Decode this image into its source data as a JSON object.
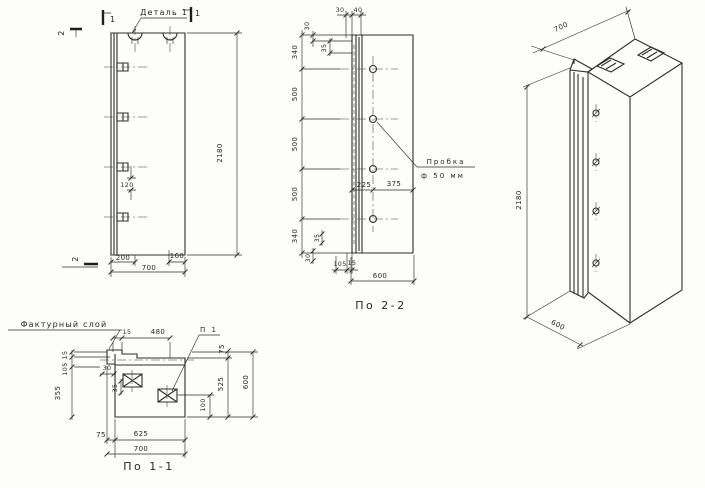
{
  "front": {
    "detail_label": "Деталь 1",
    "section_marks": {
      "s1a": "1",
      "s1b": "1",
      "s2a": "2",
      "s2b": "2"
    },
    "dims": {
      "left": "200",
      "right": "160",
      "width": "700",
      "height": "2180",
      "anchor_gap": "120"
    }
  },
  "section_2_2": {
    "caption": "По 2-2",
    "plug_label": {
      "line1": "Пробка",
      "line2": "ф 50 мм"
    },
    "dims": {
      "top_30": "30",
      "top_40": "40",
      "tl_30": "30",
      "tl_35": "35",
      "chain": [
        "340",
        "500",
        "500",
        "500",
        "340"
      ],
      "hole_left": "225",
      "hole_right": "375",
      "bl_35": "35",
      "bl_30": "30",
      "b_105": "105",
      "b_15": "15",
      "width": "600"
    }
  },
  "section_1_1": {
    "caption": "По 1-1",
    "layer_label": "Фактурный слой",
    "loop_label": "П 1",
    "dims": {
      "top_15": "15",
      "top_480": "480",
      "right_75": "75",
      "right_525": "525",
      "right_600": "600",
      "loop_100": "100",
      "left_15": "15",
      "left_105": "105",
      "left_355": "355",
      "hook_30": "30",
      "hook_35": "35",
      "bottom_75": "75",
      "bottom_625": "625",
      "bottom_700": "700"
    }
  },
  "isometric": {
    "dims": {
      "width": "700",
      "height": "2180",
      "depth": "600"
    }
  }
}
